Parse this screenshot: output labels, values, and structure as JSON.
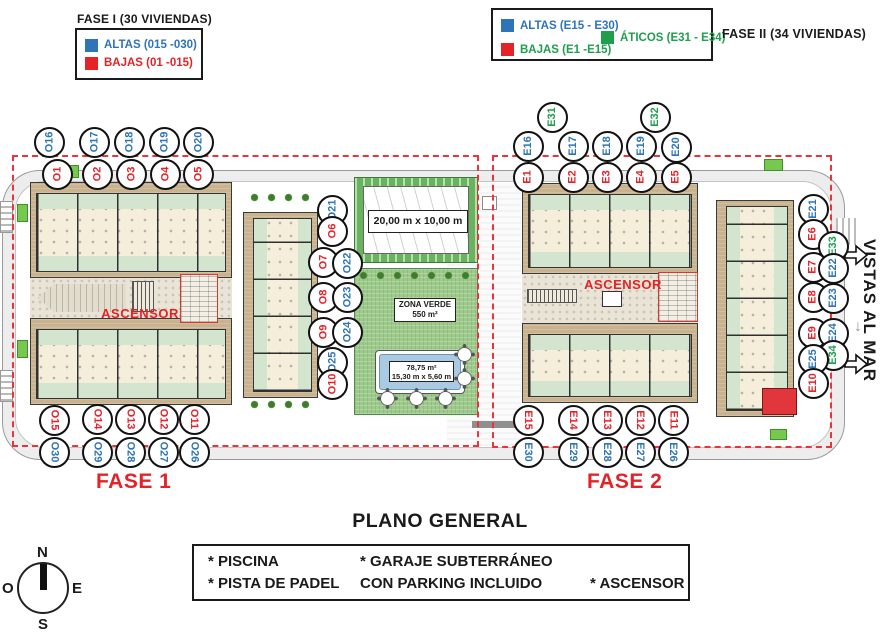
{
  "colors": {
    "blue": "#2e74b6",
    "red": "#e32328",
    "green": "#1f9e4d",
    "building_tan": "#c9b28e",
    "zona_verde": "#9dc98a",
    "pool": "#aac9e2",
    "dashed_boundary": "#e8353b"
  },
  "legend_fase1": {
    "title": "FASE I (30 VIVIENDAS)",
    "altas": "ALTAS (015 -030)",
    "bajas": "BAJAS (01 -015)"
  },
  "legend_fase2": {
    "title": "FASE II (34 VIVIENDAS)",
    "altas": "ALTAS (E15 - E30)",
    "bajas": "BAJAS (E1 -E15)",
    "aticos": "ÁTICOS (E31 - E34)"
  },
  "plan": {
    "fase1_label": "FASE 1",
    "fase2_label": "FASE 2",
    "ascensor1": "ASCENSOR",
    "ascensor2": "ASCENSOR",
    "vistas_al_mar": "VISTAS AL MAR",
    "padel_dimensions": "20,00 m x 10,00 m",
    "zona_verde_title": "ZONA VERDE",
    "zona_verde_area": "550 m²",
    "pool_area": "78,75 m²",
    "pool_dimensions": "15,30 m x 5,60 m"
  },
  "units": [
    {
      "l": "O16",
      "x": 49,
      "y": 142,
      "c": "b",
      "r": "u"
    },
    {
      "l": "O17",
      "x": 94,
      "y": 142,
      "c": "b",
      "r": "u"
    },
    {
      "l": "O18",
      "x": 129,
      "y": 142,
      "c": "b",
      "r": "u"
    },
    {
      "l": "O19",
      "x": 164,
      "y": 142,
      "c": "b",
      "r": "u"
    },
    {
      "l": "O20",
      "x": 198,
      "y": 142,
      "c": "b",
      "r": "u"
    },
    {
      "l": "O1",
      "x": 57,
      "y": 174,
      "c": "r",
      "r": "u"
    },
    {
      "l": "O2",
      "x": 97,
      "y": 174,
      "c": "r",
      "r": "u"
    },
    {
      "l": "O3",
      "x": 131,
      "y": 174,
      "c": "r",
      "r": "u"
    },
    {
      "l": "O4",
      "x": 165,
      "y": 174,
      "c": "r",
      "r": "u"
    },
    {
      "l": "O5",
      "x": 198,
      "y": 174,
      "c": "r",
      "r": "u"
    },
    {
      "l": "O21",
      "x": 332,
      "y": 210,
      "c": "b",
      "r": "u"
    },
    {
      "l": "O6",
      "x": 332,
      "y": 231,
      "c": "r",
      "r": "u"
    },
    {
      "l": "O7",
      "x": 323,
      "y": 262,
      "c": "r",
      "r": "u"
    },
    {
      "l": "O22",
      "x": 347,
      "y": 263,
      "c": "b",
      "r": "u"
    },
    {
      "l": "O8",
      "x": 323,
      "y": 297,
      "c": "r",
      "r": "u"
    },
    {
      "l": "O23",
      "x": 347,
      "y": 297,
      "c": "b",
      "r": "u"
    },
    {
      "l": "O9",
      "x": 323,
      "y": 332,
      "c": "r",
      "r": "u"
    },
    {
      "l": "O24",
      "x": 347,
      "y": 332,
      "c": "b",
      "r": "u"
    },
    {
      "l": "O25",
      "x": 332,
      "y": 362,
      "c": "b",
      "r": "u"
    },
    {
      "l": "O10",
      "x": 332,
      "y": 384,
      "c": "r",
      "r": "u"
    },
    {
      "l": "O15",
      "x": 54,
      "y": 420,
      "c": "r",
      "r": "d"
    },
    {
      "l": "O14",
      "x": 97,
      "y": 419,
      "c": "r",
      "r": "d"
    },
    {
      "l": "O13",
      "x": 130,
      "y": 419,
      "c": "r",
      "r": "d"
    },
    {
      "l": "O12",
      "x": 163,
      "y": 419,
      "c": "r",
      "r": "d"
    },
    {
      "l": "O11",
      "x": 194,
      "y": 419,
      "c": "r",
      "r": "d"
    },
    {
      "l": "O30",
      "x": 54,
      "y": 452,
      "c": "b",
      "r": "d"
    },
    {
      "l": "O29",
      "x": 97,
      "y": 452,
      "c": "b",
      "r": "d"
    },
    {
      "l": "O28",
      "x": 130,
      "y": 452,
      "c": "b",
      "r": "d"
    },
    {
      "l": "O27",
      "x": 163,
      "y": 452,
      "c": "b",
      "r": "d"
    },
    {
      "l": "O26",
      "x": 194,
      "y": 452,
      "c": "b",
      "r": "d"
    },
    {
      "l": "E31",
      "x": 552,
      "y": 117,
      "c": "g",
      "r": "u"
    },
    {
      "l": "E32",
      "x": 655,
      "y": 117,
      "c": "g",
      "r": "u"
    },
    {
      "l": "E16",
      "x": 528,
      "y": 146,
      "c": "b",
      "r": "u"
    },
    {
      "l": "E17",
      "x": 573,
      "y": 146,
      "c": "b",
      "r": "u"
    },
    {
      "l": "E18",
      "x": 607,
      "y": 146,
      "c": "b",
      "r": "u"
    },
    {
      "l": "E19",
      "x": 641,
      "y": 146,
      "c": "b",
      "r": "u"
    },
    {
      "l": "E20",
      "x": 676,
      "y": 147,
      "c": "b",
      "r": "u"
    },
    {
      "l": "E1",
      "x": 528,
      "y": 177,
      "c": "r",
      "r": "u"
    },
    {
      "l": "E2",
      "x": 573,
      "y": 177,
      "c": "r",
      "r": "u"
    },
    {
      "l": "E3",
      "x": 607,
      "y": 177,
      "c": "r",
      "r": "u"
    },
    {
      "l": "E4",
      "x": 641,
      "y": 177,
      "c": "r",
      "r": "u"
    },
    {
      "l": "E5",
      "x": 676,
      "y": 177,
      "c": "r",
      "r": "u"
    },
    {
      "l": "E21",
      "x": 813,
      "y": 209,
      "c": "b",
      "r": "u"
    },
    {
      "l": "E6",
      "x": 813,
      "y": 234,
      "c": "r",
      "r": "u"
    },
    {
      "l": "E33",
      "x": 833,
      "y": 246,
      "c": "g",
      "r": "u"
    },
    {
      "l": "E7",
      "x": 813,
      "y": 267,
      "c": "r",
      "r": "u"
    },
    {
      "l": "E22",
      "x": 833,
      "y": 268,
      "c": "b",
      "r": "u"
    },
    {
      "l": "E8",
      "x": 813,
      "y": 297,
      "c": "r",
      "r": "u"
    },
    {
      "l": "E23",
      "x": 833,
      "y": 298,
      "c": "b",
      "r": "u"
    },
    {
      "l": "E9",
      "x": 813,
      "y": 333,
      "c": "r",
      "r": "u"
    },
    {
      "l": "E24",
      "x": 833,
      "y": 333,
      "c": "b",
      "r": "u"
    },
    {
      "l": "E34",
      "x": 833,
      "y": 355,
      "c": "g",
      "r": "u"
    },
    {
      "l": "E25",
      "x": 813,
      "y": 359,
      "c": "b",
      "r": "u"
    },
    {
      "l": "E10",
      "x": 813,
      "y": 383,
      "c": "r",
      "r": "u"
    },
    {
      "l": "E15",
      "x": 528,
      "y": 420,
      "c": "r",
      "r": "d"
    },
    {
      "l": "E14",
      "x": 573,
      "y": 420,
      "c": "r",
      "r": "d"
    },
    {
      "l": "E13",
      "x": 607,
      "y": 420,
      "c": "r",
      "r": "d"
    },
    {
      "l": "E12",
      "x": 640,
      "y": 420,
      "c": "r",
      "r": "d"
    },
    {
      "l": "E11",
      "x": 673,
      "y": 420,
      "c": "r",
      "r": "d"
    },
    {
      "l": "E30",
      "x": 528,
      "y": 452,
      "c": "b",
      "r": "d"
    },
    {
      "l": "E29",
      "x": 573,
      "y": 452,
      "c": "b",
      "r": "d"
    },
    {
      "l": "E28",
      "x": 607,
      "y": 452,
      "c": "b",
      "r": "d"
    },
    {
      "l": "E27",
      "x": 640,
      "y": 452,
      "c": "b",
      "r": "d"
    },
    {
      "l": "E26",
      "x": 673,
      "y": 452,
      "c": "b",
      "r": "d"
    }
  ],
  "footer": {
    "title": "PLANO GENERAL",
    "facilities": {
      "piscina": "* PISCINA",
      "garaje": "* GARAJE SUBTERRÁNEO",
      "padel": "* PISTA DE PADEL",
      "parking": "CON PARKING INCLUIDO",
      "ascensor": "* ASCENSOR"
    }
  },
  "compass": {
    "n": "N",
    "s": "S",
    "e": "E",
    "o": "O"
  }
}
